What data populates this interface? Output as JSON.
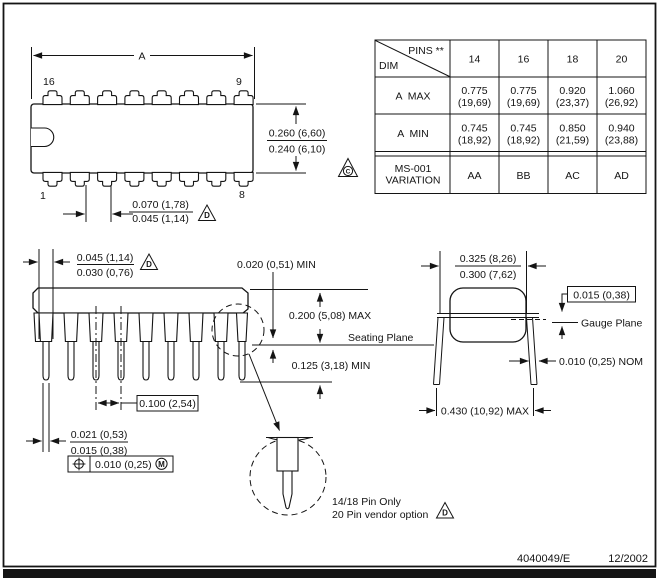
{
  "top_view": {
    "a_label": "A",
    "pin16": "16",
    "pin9": "9",
    "pin1": "1",
    "pin8": "8",
    "body_h_top": "0.260 (6,60)",
    "body_h_bot": "0.240 (6,10)",
    "lead_w_top": "0.070 (1,78)",
    "lead_w_bot": "0.045 (1,14)",
    "note": "D"
  },
  "table": {
    "pins_label": "PINS **",
    "dim_label": "DIM",
    "cols": [
      "14",
      "16",
      "18",
      "20"
    ],
    "a_max": {
      "label": "A  MAX",
      "v": [
        {
          "in": "0.775",
          "mm": "(19,69)"
        },
        {
          "in": "0.775",
          "mm": "(19,69)"
        },
        {
          "in": "0.920",
          "mm": "(23,37)"
        },
        {
          "in": "1.060",
          "mm": "(26,92)"
        }
      ]
    },
    "a_min": {
      "label": "A  MIN",
      "v": [
        {
          "in": "0.745",
          "mm": "(18,92)"
        },
        {
          "in": "0.745",
          "mm": "(18,92)"
        },
        {
          "in": "0.850",
          "mm": "(21,59)"
        },
        {
          "in": "0.940",
          "mm": "(23,88)"
        }
      ]
    },
    "variation": {
      "label1": "MS-001",
      "label2": "VARIATION",
      "v": [
        "AA",
        "BB",
        "AC",
        "AD"
      ]
    },
    "note": "C"
  },
  "side_view": {
    "shoulder_top": "0.045 (1,14)",
    "shoulder_bot": "0.030 (0,76)",
    "note1": "D",
    "standoff": "0.020 (0,51) MIN",
    "height": "0.200 (5,08) MAX",
    "seating": "Seating Plane",
    "tip_len": "0.125 (3,18) MIN",
    "pitch": "0.100 (2,54)",
    "leg_top": "0.021 (0,53)",
    "leg_bot": "0.015 (0,38)",
    "fcf_tol": "0.010 (0,25)",
    "fcf_mod": "M"
  },
  "end_view": {
    "row_top": "0.325 (8,26)",
    "row_bot": "0.300 (7,62)",
    "gauge_off": "0.015 (0,38)",
    "gauge": "Gauge Plane",
    "lead_thk": "0.010 (0,25) NOM",
    "span": "0.430 (10,92) MAX"
  },
  "detail": {
    "line1": "14/18 Pin Only",
    "line2": "20 Pin vendor option",
    "note": "D"
  },
  "footer": {
    "doc": "4040049/E",
    "date": "12/2002"
  }
}
